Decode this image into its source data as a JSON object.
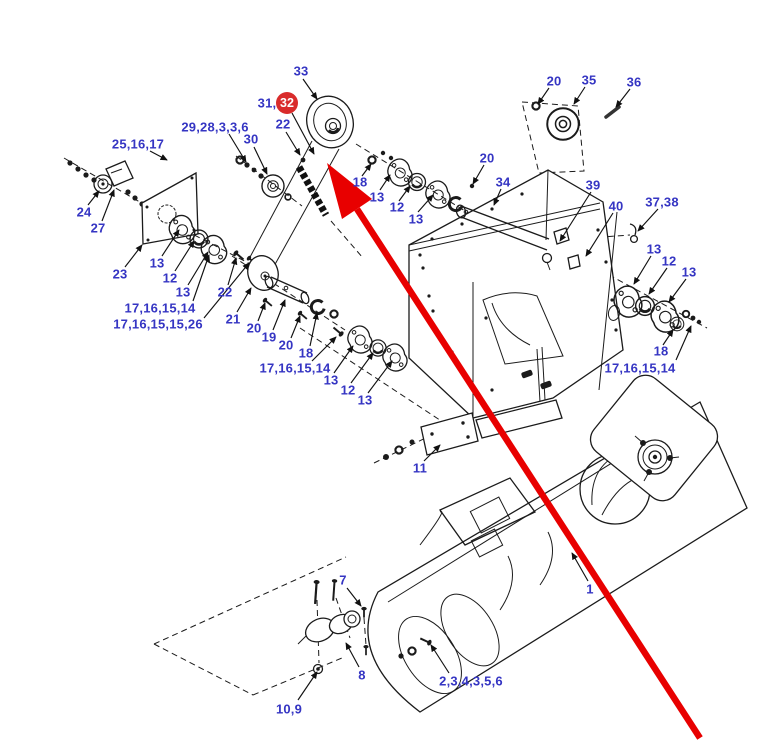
{
  "figure": {
    "background": "#ffffff",
    "label_color": "#3535c3",
    "line_color": "#1b1b1b",
    "highlight": {
      "badge_text": "32",
      "badge_fill": "#d92b2b",
      "badge_text_color": "#ffffff",
      "arrow_color": "#e80000"
    },
    "callouts": [
      {
        "text": "25,16,17"
      },
      {
        "text": "29,28,3,3,6"
      },
      {
        "text": "33"
      },
      {
        "text": "31,"
      },
      {
        "text": "22"
      },
      {
        "text": "30"
      },
      {
        "text": "20"
      },
      {
        "text": "35"
      },
      {
        "text": "36"
      },
      {
        "text": "18"
      },
      {
        "text": "13"
      },
      {
        "text": "12"
      },
      {
        "text": "13"
      },
      {
        "text": "20"
      },
      {
        "text": "34"
      },
      {
        "text": "39"
      },
      {
        "text": "40"
      },
      {
        "text": "37,38"
      },
      {
        "text": "13"
      },
      {
        "text": "12"
      },
      {
        "text": "13"
      },
      {
        "text": "18"
      },
      {
        "text": "17,16,15,14"
      },
      {
        "text": "24"
      },
      {
        "text": "27"
      },
      {
        "text": "23"
      },
      {
        "text": "13"
      },
      {
        "text": "12"
      },
      {
        "text": "13"
      },
      {
        "text": "22"
      },
      {
        "text": "21"
      },
      {
        "text": "20"
      },
      {
        "text": "19"
      },
      {
        "text": "20"
      },
      {
        "text": "18"
      },
      {
        "text": "17,16,15,14"
      },
      {
        "text": "17,16,15,15,26"
      },
      {
        "text": "17,16,15,14"
      },
      {
        "text": "13"
      },
      {
        "text": "12"
      },
      {
        "text": "13"
      },
      {
        "text": "11"
      },
      {
        "text": "1"
      },
      {
        "text": "7"
      },
      {
        "text": "8"
      },
      {
        "text": "10,9"
      },
      {
        "text": "2,3,4,3,5,6"
      }
    ]
  }
}
